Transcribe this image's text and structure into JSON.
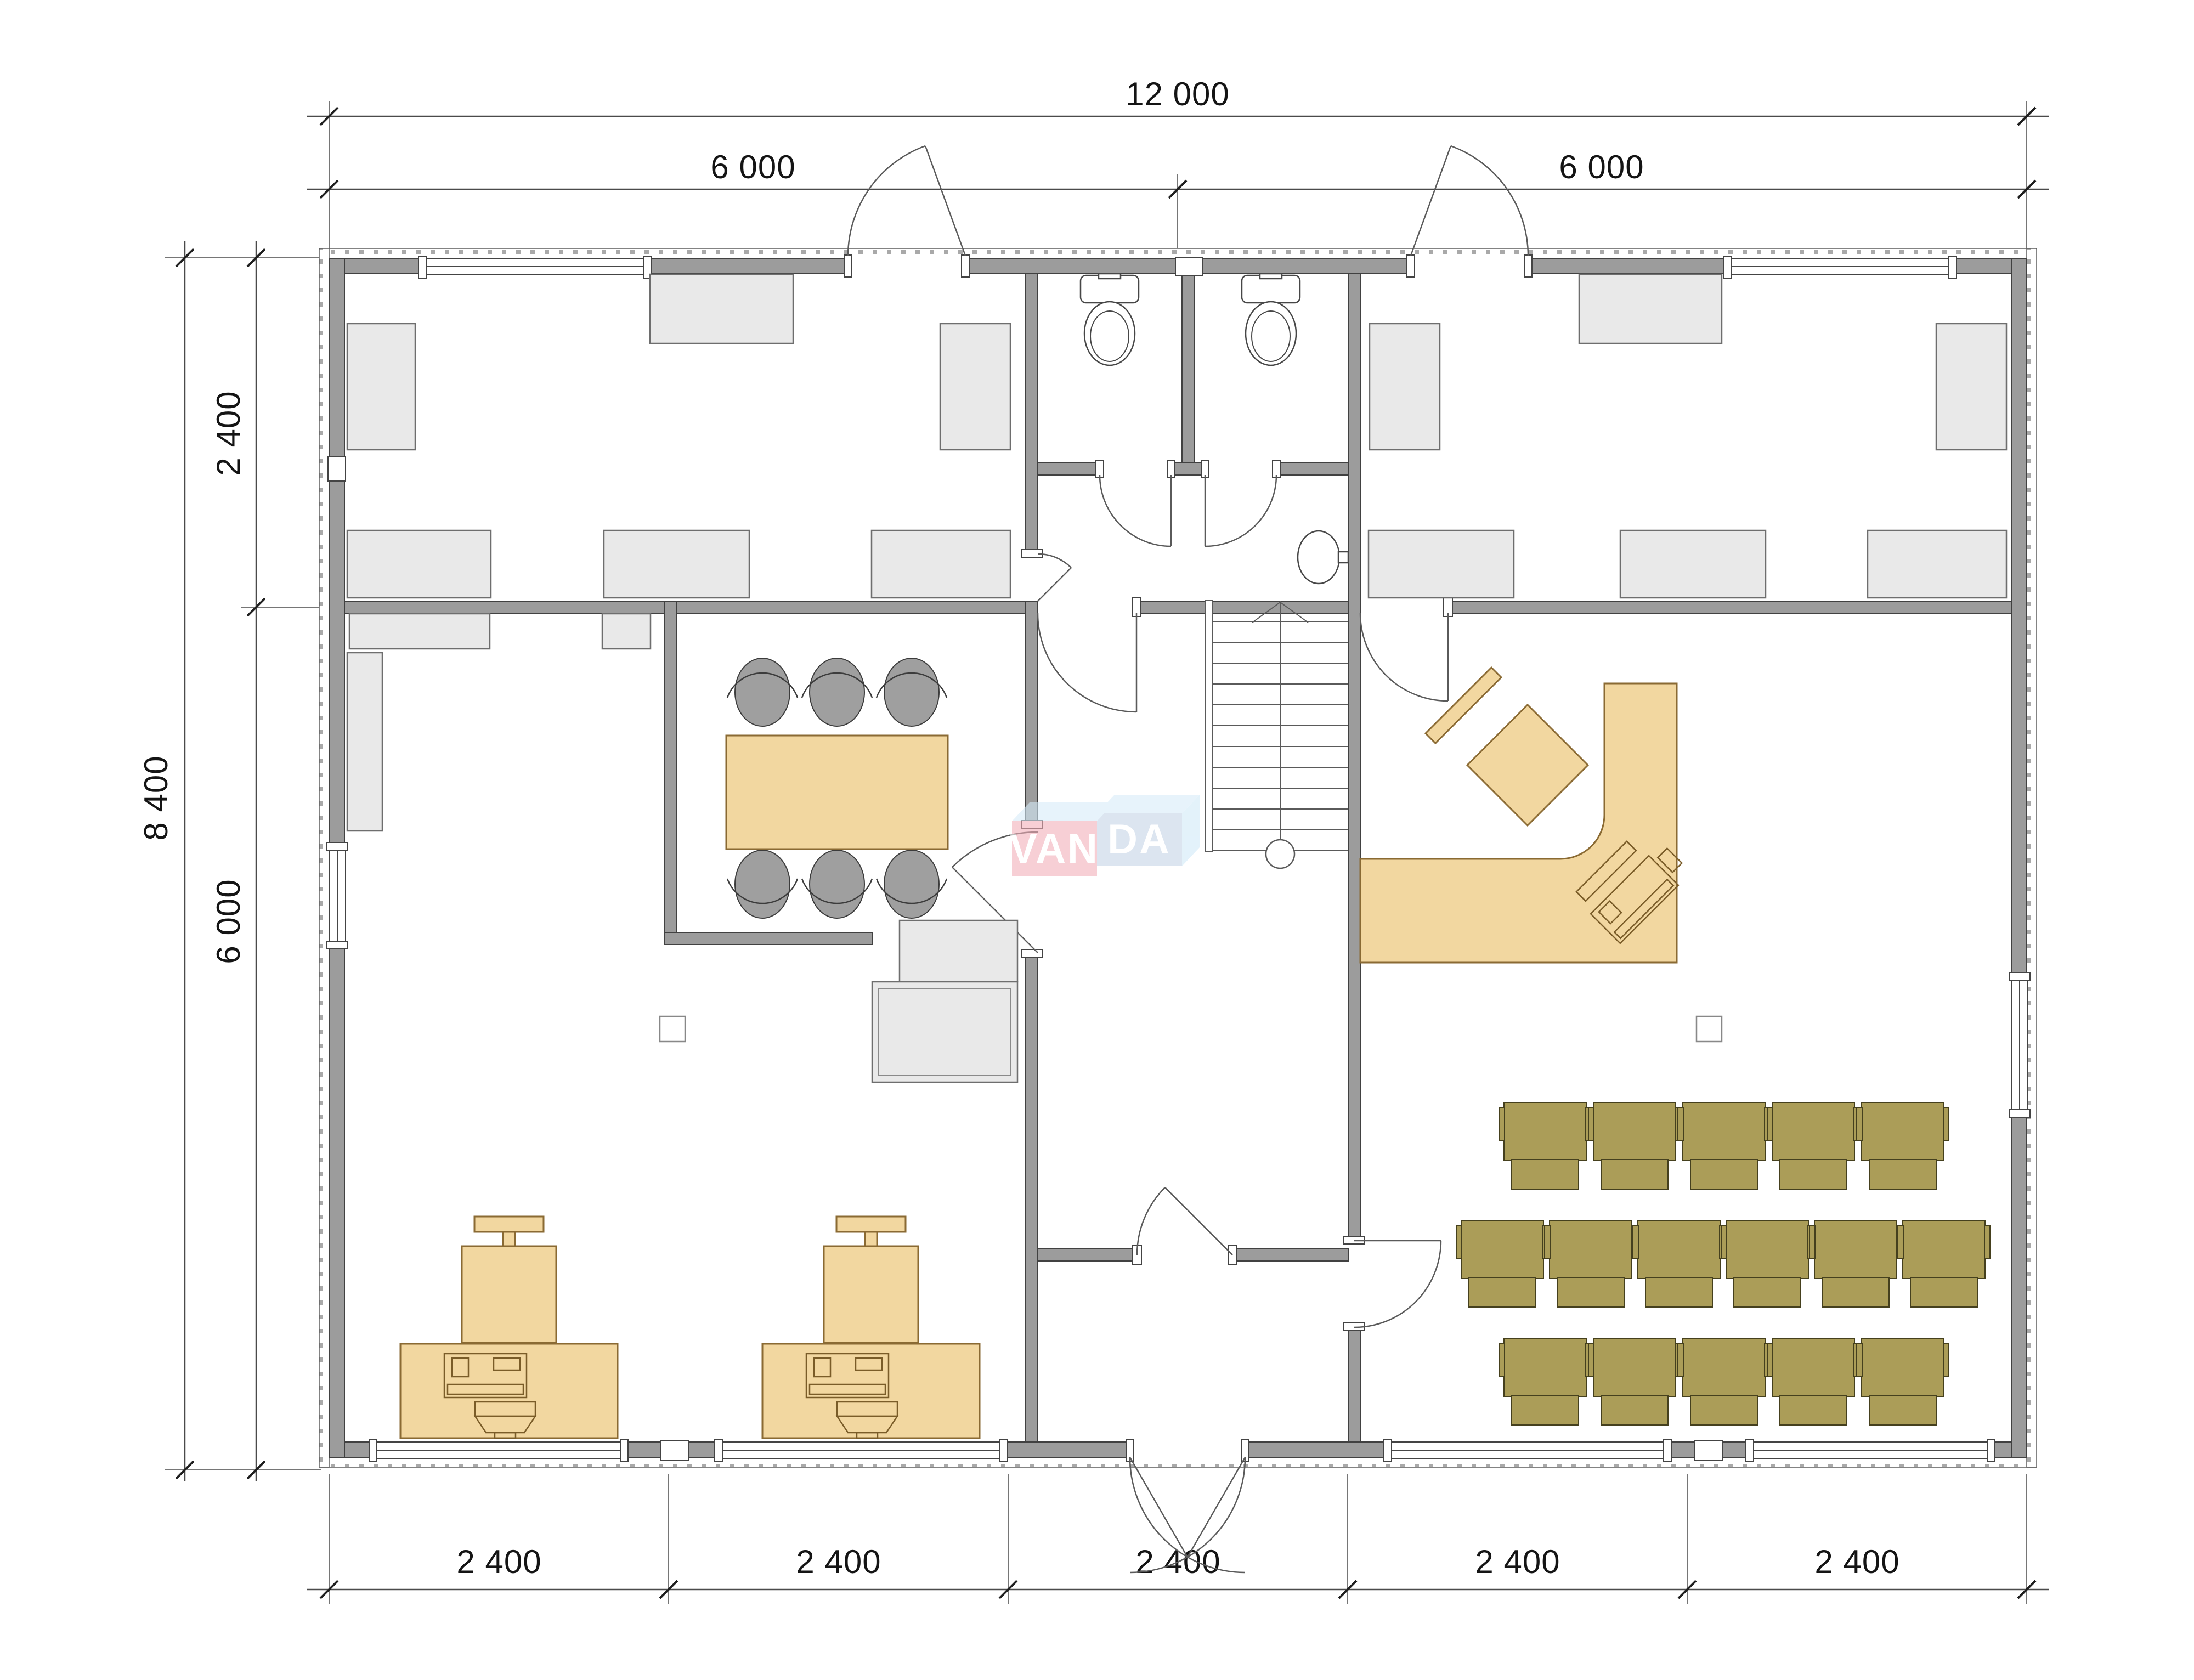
{
  "floor_plan": {
    "dimensions": {
      "top_total": "12 000",
      "top_segments": [
        "6 000",
        "6 000"
      ],
      "side_total": "8 400",
      "side_segments": [
        "2 400",
        "6 000"
      ],
      "bottom_segments": [
        "2 400",
        "2 400",
        "2 400",
        "2 400",
        "2 400"
      ]
    },
    "watermark": {
      "part1": "VAN",
      "part2": "DA"
    },
    "colors": {
      "wall_gray": "#9c9c9c",
      "furniture_gray": "#e9e9e9",
      "desk_tan": "#f2d7a0",
      "desk_outline": "#8a6a33",
      "audience_chair_olive": "#ab9d58",
      "meeting_chair_gray": "#9f9f9f",
      "watermark_pink": "#f2adb8",
      "watermark_blue": "#c3d3e6",
      "watermark_light_blue": "#d6ecf9"
    }
  }
}
